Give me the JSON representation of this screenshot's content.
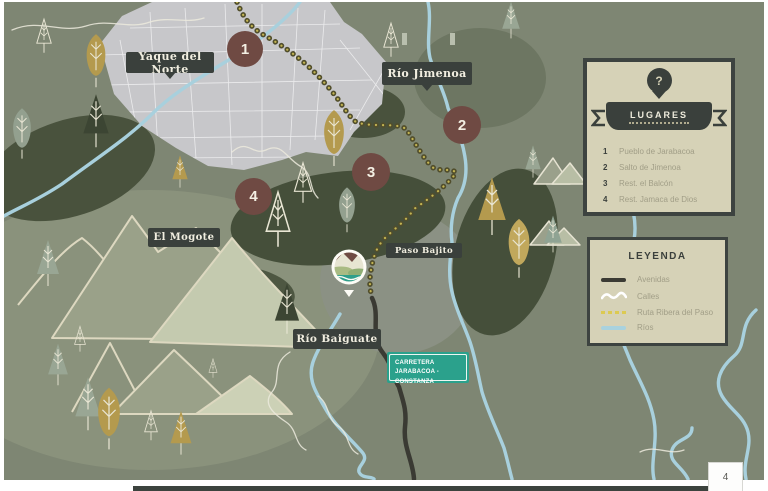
{
  "page_number": "4",
  "map_labels": {
    "yaque": "Yaque del Norte",
    "jimenoa": "Río Jimenoa",
    "mogote": "El Mogote",
    "paso_bajito": "Paso Bajito",
    "baiguate": "Río Baiguate"
  },
  "markers": [
    "1",
    "2",
    "3",
    "4"
  ],
  "lugares": {
    "title": "LUGARES",
    "pin_symbol": "?",
    "items": [
      {
        "num": "1",
        "label": "Pueblo de Jarabacoa"
      },
      {
        "num": "2",
        "label": "Salto de Jimenoa"
      },
      {
        "num": "3",
        "label": "Rest. el Balcón"
      },
      {
        "num": "4",
        "label": "Rest. Jamaca de Dios"
      }
    ]
  },
  "leyenda": {
    "title": "LEYENDA",
    "items": [
      {
        "symbol": "avenidas-line",
        "label": "Avenidas"
      },
      {
        "symbol": "calles-wave",
        "label": "Calles"
      },
      {
        "symbol": "ruta-dashes",
        "label": "Ruta Ribera del Paso"
      },
      {
        "symbol": "rios-line",
        "label": "Ríos"
      }
    ]
  },
  "road_sign": {
    "line1": "CARRETERA",
    "line2": "JARABACOA - CONSTANZA"
  },
  "icons": {
    "lugares_pin": "question-pin",
    "logo": "river-landscape-badge",
    "ribbon": "banner-ribbon"
  },
  "colors": {
    "map_base": "#7e8673",
    "label_bg": "#3a403c",
    "marker": "#6f4a43",
    "panel_bg": "#d6d2b7",
    "panel_border": "#3d4340",
    "river": "#a8d0dd",
    "route_yellow": "#dcca52",
    "road_dark": "#3b3b34",
    "sign_teal": "#2ba18c",
    "muted_text": "#a19e87"
  }
}
